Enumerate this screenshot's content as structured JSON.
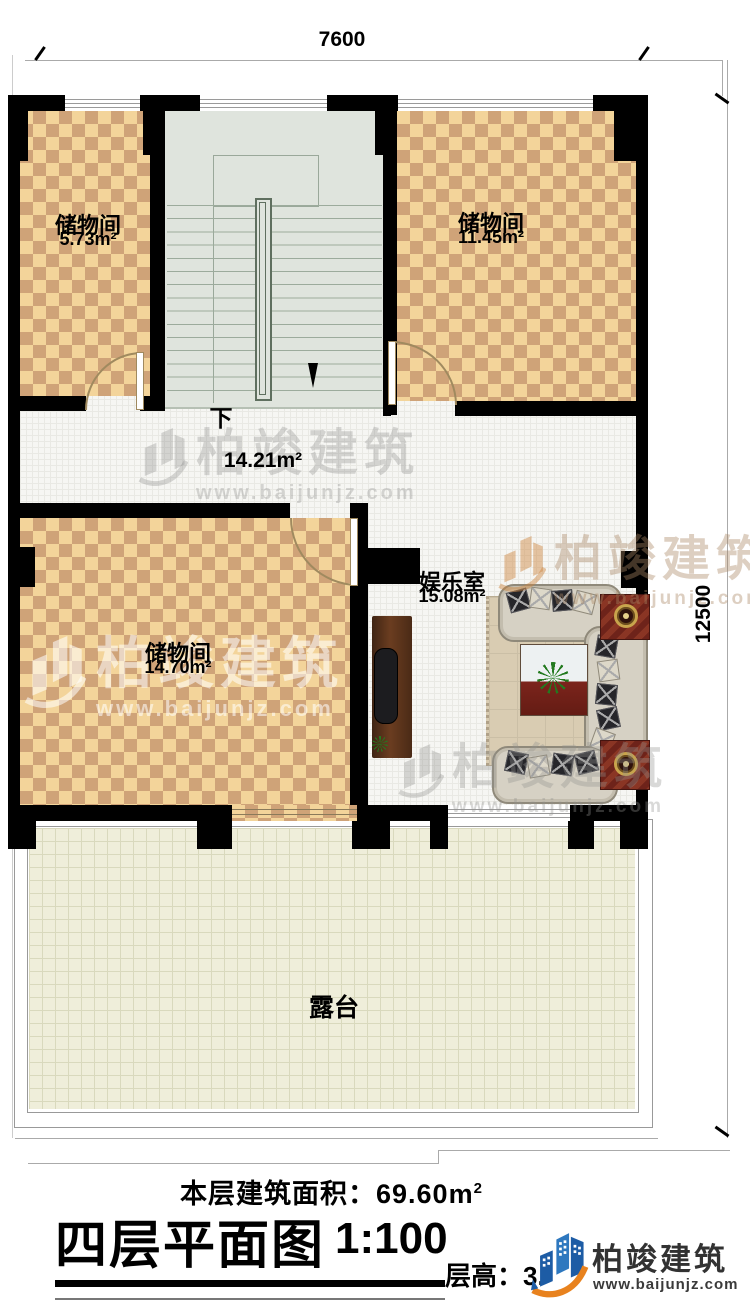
{
  "dimension_top": "7600",
  "dimension_right": "12500",
  "rooms": [
    {
      "name": "储物间",
      "area": "5.73m²"
    },
    {
      "name": "储物间",
      "area": "11.45m²"
    },
    {
      "name": "储物间",
      "area": "14.70m²"
    },
    {
      "name": "娱乐室",
      "area": "15.08m²"
    }
  ],
  "stair": {
    "down_label": "下"
  },
  "hall": {
    "area": "14.21m²"
  },
  "terrace_label": "露台",
  "footer": {
    "floor_area_prefix": "本层建筑面积：",
    "floor_area_value": "69.60m",
    "floor_area_exponent": "2",
    "title": "四层平面图",
    "scale": "1:100",
    "floor_height": "层高：3.",
    "brand": "柏竣建筑",
    "brand_url": "www.baijunjz.com"
  },
  "watermark": {
    "text": "柏竣建筑",
    "url": "www.baijunjz.com"
  },
  "colors": {
    "wall": "#000000",
    "checker_light": "#f3d49a",
    "checker_dark": "#cfa378",
    "stair_floor": "#dfe4dd",
    "terrace_floor": "#efeeda",
    "brand_blue": "#1d5ca5",
    "brand_orange": "#e8821e"
  }
}
